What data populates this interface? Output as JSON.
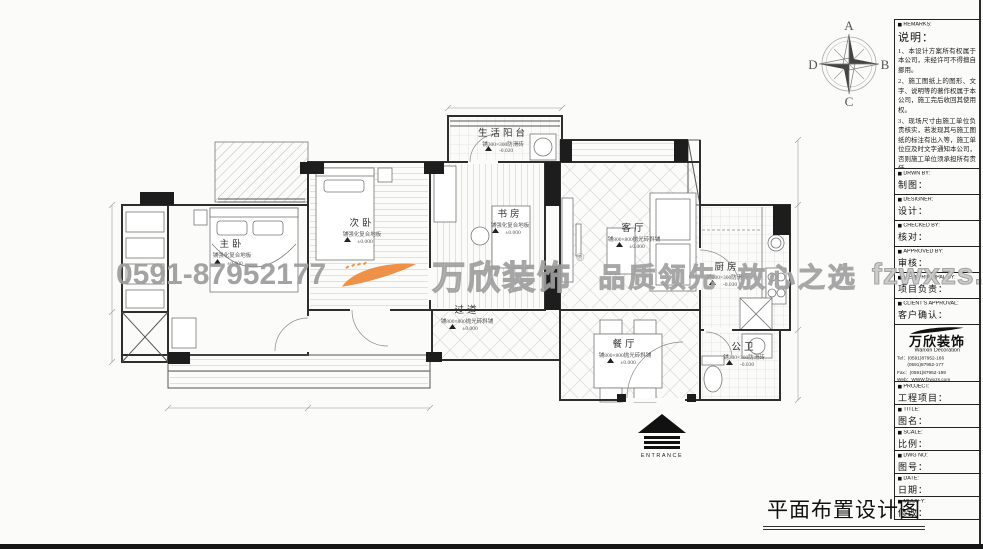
{
  "page": {
    "caption": "平面布置设计图"
  },
  "colors": {
    "accent_orange": "#ef8a3b",
    "watermark_gray": "#a8a8a8",
    "line_dark": "#2e2e2e"
  },
  "watermark": {
    "phone": "0591-87952177",
    "brand": "万欣装饰",
    "reg": "®",
    "slogan": "品质领先  放心之选",
    "site": "fzwxzs.com"
  },
  "compass": {
    "n": "A",
    "e": "B",
    "s": "C",
    "w": "D"
  },
  "entrance": {
    "label": "ENTRANCE"
  },
  "rooms": [
    {
      "name": "主卧",
      "floor": "铺强化复合地板",
      "level": "±0.000"
    },
    {
      "name": "次卧",
      "floor": "铺强化复合地板",
      "level": "±0.000"
    },
    {
      "name": "书房",
      "floor": "铺强化复合地板",
      "level": "±0.000"
    },
    {
      "name": "生活阳台",
      "floor": "铺300×300防滑砖",
      "level": "-0.020"
    },
    {
      "name": "客厅",
      "floor": "铺800×800抛光砖斜铺",
      "level": "±0.000"
    },
    {
      "name": "过道",
      "floor": "铺800×800抛光砖斜铺",
      "level": "±0.000"
    },
    {
      "name": "餐厅",
      "floor": "铺800×800抛光砖斜铺",
      "level": "±0.000"
    },
    {
      "name": "厨房",
      "floor": "铺300×300防滑砖",
      "level": "-0.030"
    },
    {
      "name": "公卫",
      "floor": "铺300×300防滑砖",
      "level": "-0.030"
    }
  ],
  "titleblock": {
    "remarks": {
      "en": "REMARKS:",
      "cn": "说明：",
      "items": [
        "1、本设计方案所有权属于本公司，未经许可不得擅自挪用。",
        "2、施工图纸上的图形、文字、说明等的著作权属于本公司，施工完后收回其使用权。",
        "3、现场尺寸由施工单位负责核实，若发现其与施工图纸的标注有出入等，施工单位应及时文字通知本公司，否则施工单位须承担所有责任。",
        "4、本设计方案是根据客户要求设计，经客户签字即视为同意认可，不得随意更改。"
      ]
    },
    "fields": [
      {
        "en": "DRWN BY:",
        "cn": "制图："
      },
      {
        "en": "DESIGNER:",
        "cn": "设计："
      },
      {
        "en": "CHECKED BY:",
        "cn": "核对："
      },
      {
        "en": "APPROVED BY:",
        "cn": "审核："
      },
      {
        "en": "ITEM PRINCIPAL BY:",
        "cn": "项目负责："
      },
      {
        "en": "CLIENT'S APPROVAL:",
        "cn": "客户确认："
      }
    ],
    "company": {
      "brand_cn": "万欣装饰",
      "brand_en": "Wanxin Decoration",
      "tel1": "Tel：(0591)87952-166",
      "tel2": "(0591)87952-177",
      "fax": "Fax：(0591)87952-199",
      "web": "Web：WWW.fzwxzs.com"
    },
    "fields2": [
      {
        "en": "PROJECT:",
        "cn": "工程项目："
      },
      {
        "en": "TITLE:",
        "cn": "图名："
      },
      {
        "en": "SCALE:",
        "cn": "比例："
      },
      {
        "en": "DWG NO:",
        "cn": "图号："
      },
      {
        "en": "DATE:",
        "cn": "日期："
      },
      {
        "en": "MODIFY:",
        "cn": "修改："
      }
    ]
  }
}
